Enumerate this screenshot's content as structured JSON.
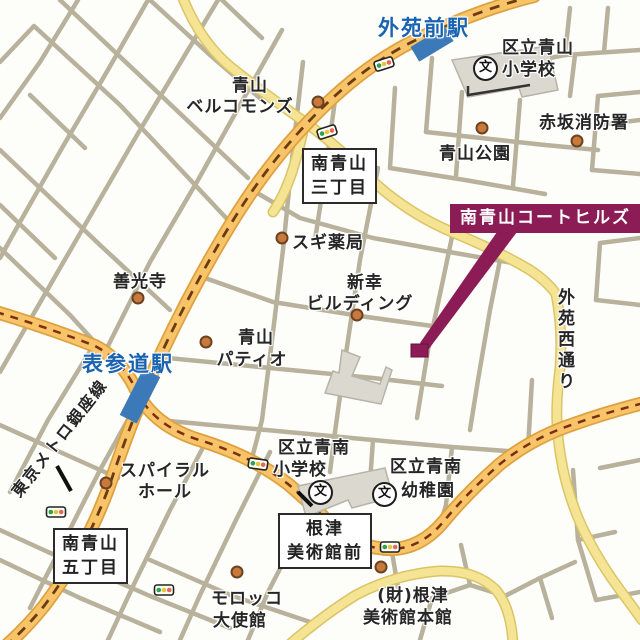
{
  "map": {
    "background": "#fdfdfa",
    "colors": {
      "road_minor": "#b8b19b",
      "road_major_fill": "#f7c469",
      "road_major_edge": "#dfa13e",
      "road_yellow_fill": "#f4e494",
      "road_yellow_edge": "#dcc466",
      "railway_dash": "#6e3a12",
      "station_blue": "#3c79b8",
      "station_text_blue": "#1a63b0",
      "highlight_purple": "#8c1c55",
      "landmark_dot": "#c8793c",
      "building_gray": "#dbd8d0"
    }
  },
  "stations": {
    "gaienmae": "外苑前駅",
    "omotesando": "表参道駅"
  },
  "railway": {
    "ginza_line": "東京メトロ銀座線"
  },
  "streets": {
    "gaien_nishi": "外苑西通り"
  },
  "highlight": {
    "label": "南青山コートヒルズ"
  },
  "boxes": {
    "sanchome": {
      "line1": "南青山",
      "line2": "三丁目"
    },
    "gochome": {
      "line1": "南青山",
      "line2": "五丁目"
    },
    "nezu_mae": {
      "line1": "根津",
      "line2": "美術館前"
    }
  },
  "landmarks": {
    "bellcommons": {
      "line1": "青山",
      "line2": "ベルコモンズ"
    },
    "aoyama_elementary": {
      "line1": "区立青山",
      "line2": "小学校"
    },
    "akasaka_fire": {
      "line1": "赤坂消防署"
    },
    "aoyama_park": {
      "line1": "青山公園"
    },
    "sugi_pharmacy": {
      "line1": "スギ薬局"
    },
    "zenkoji": {
      "line1": "善光寺"
    },
    "shinko_building": {
      "line1": "新幸",
      "line2": "ビルディング"
    },
    "aoyama_patio": {
      "line1": "青山",
      "line2": "パティオ"
    },
    "spiral_hall": {
      "line1": "スパイラル",
      "line2": "ホール"
    },
    "seinan_elementary": {
      "line1": "区立青南",
      "line2": "小学校"
    },
    "seinan_kindergarten": {
      "line1": "区立青南",
      "line2": "幼稚園"
    },
    "morocco_embassy": {
      "line1": "モロッコ",
      "line2": "大使館"
    },
    "nezu_museum": {
      "line1": "(財)根津",
      "line2": "美術館本館"
    }
  },
  "icons": {
    "school_symbol": "文"
  }
}
